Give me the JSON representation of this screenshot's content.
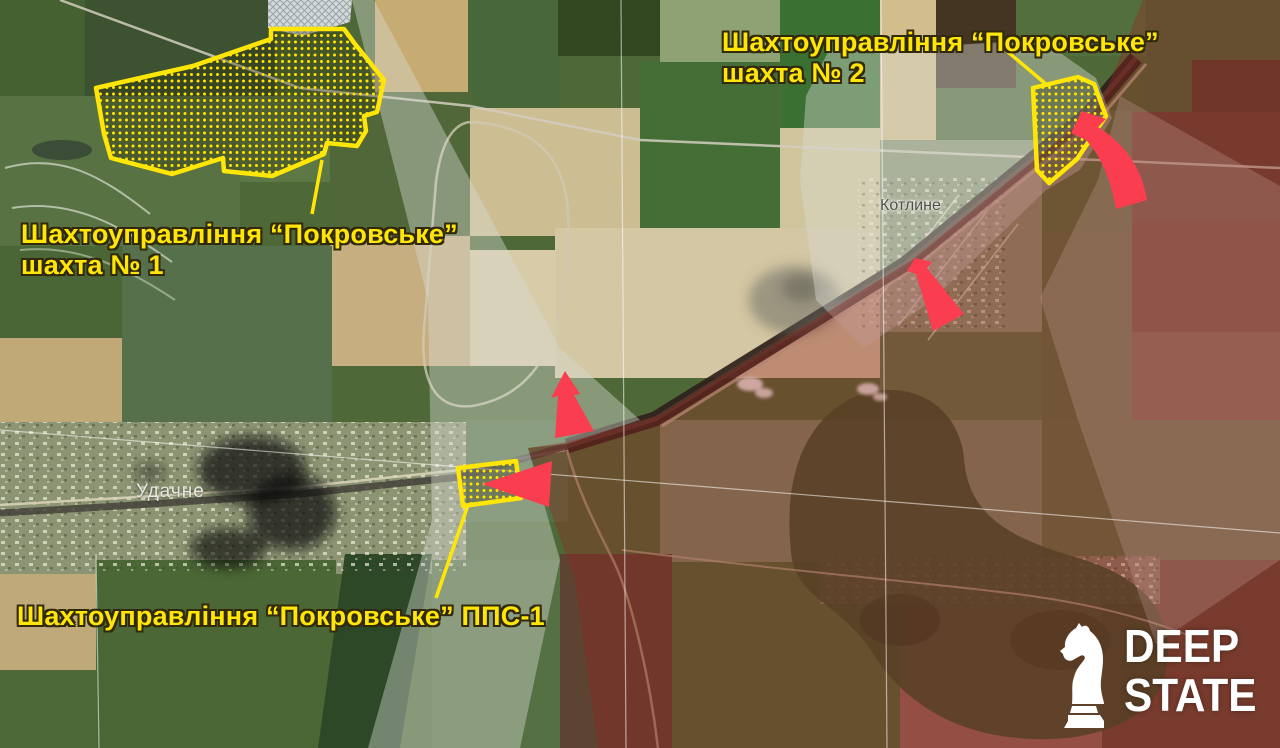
{
  "annotations": {
    "mine1": {
      "line1": "Шахтоуправління “Покровське”",
      "line2": "шахта № 1"
    },
    "mine2": {
      "line1": "Шахтоуправління “Покровське”",
      "line2": "шахта № 2"
    },
    "pps1": {
      "line1": "Шахтоуправління “Покровське” ППС-1"
    }
  },
  "villages": {
    "kotlyne": "Котлине",
    "udachne": "Удачне"
  },
  "logo": {
    "line1": "DEEP",
    "line2": "STATE"
  },
  "colors": {
    "facility_highlight": "#ffe606",
    "arrow_red": "#fa3e4f",
    "occupied_overlay": "rgba(150,35,30,0.36)",
    "contested_overlay": "rgba(216,219,213,0.42)",
    "logo_white": "#ffffff"
  }
}
